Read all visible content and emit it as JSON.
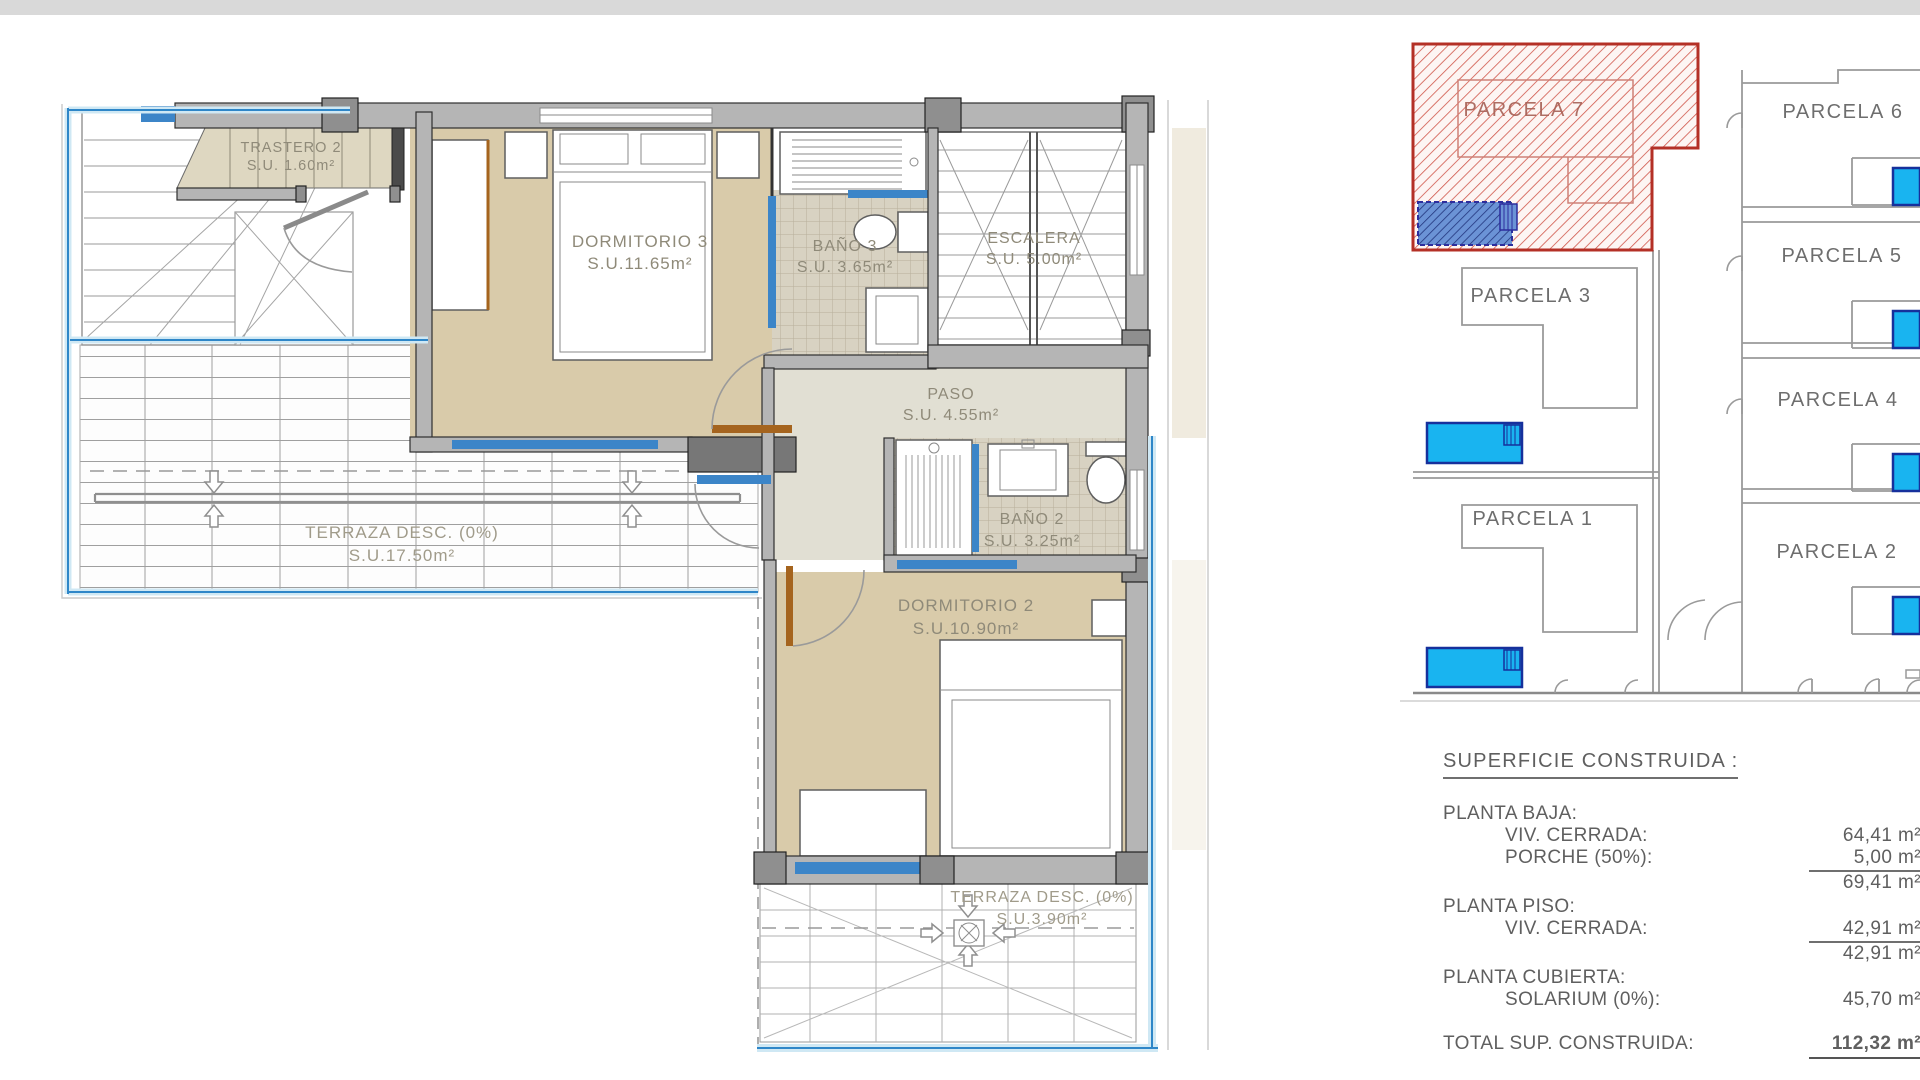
{
  "floorplan": {
    "trastero2_name": "TRASTERO 2",
    "trastero2_area": "S.U. 1.60m²",
    "dormitorio3_name": "DORMITORIO 3",
    "dormitorio3_area": "S.U.11.65m²",
    "bano3_name": "BAÑO 3",
    "bano3_area": "S.U. 3.65m²",
    "escalera_name": "ESCALERA",
    "escalera_area": "S.U. 5.00m²",
    "paso_name": "PASO",
    "paso_area": "S.U. 4.55m²",
    "bano2_name": "BAÑO 2",
    "bano2_area": "S.U. 3.25m²",
    "dormitorio2_name": "DORMITORIO 2",
    "dormitorio2_area": "S.U.10.90m²",
    "terraza1_name": "TERRAZA DESC. (0%)",
    "terraza1_area": "S.U.17.50m²",
    "terraza2_name": "TERRAZA DESC. (0%)",
    "terraza2_area": "S.U.3.90m²"
  },
  "siteplan": {
    "parcela7": "PARCELA 7",
    "parcela6": "PARCELA 6",
    "parcela5": "PARCELA 5",
    "parcela3": "PARCELA 3",
    "parcela4": "PARCELA 4",
    "parcela1": "PARCELA 1",
    "parcela2": "PARCELA 2"
  },
  "summary": {
    "title": "SUPERFICIE CONSTRUIDA :",
    "planta_baja_label": "PLANTA BAJA:",
    "viv_cerrada_baja_label": "VIV. CERRADA:",
    "viv_cerrada_baja_value": "64,41 m²",
    "porche_label": "PORCHE (50%):",
    "porche_value": "5,00 m²",
    "baja_subtotal": "69,41 m²",
    "planta_piso_label": "PLANTA PISO:",
    "viv_cerrada_piso_label": "VIV. CERRADA:",
    "viv_cerrada_piso_value": "42,91 m²",
    "piso_subtotal": "42,91 m²",
    "planta_cubierta_label": "PLANTA CUBIERTA:",
    "solarium_label": "SOLARIUM (0%):",
    "solarium_value": "45,70 m²",
    "total_label": "TOTAL SUP. CONSTRUIDA:",
    "total_value": "112,32 m²"
  },
  "palette": {
    "highlight_red": "#b43026",
    "pool_cyan": "#19b4f0",
    "window_blue": "#3c85c8",
    "room_beige": "#d9cbaa"
  }
}
